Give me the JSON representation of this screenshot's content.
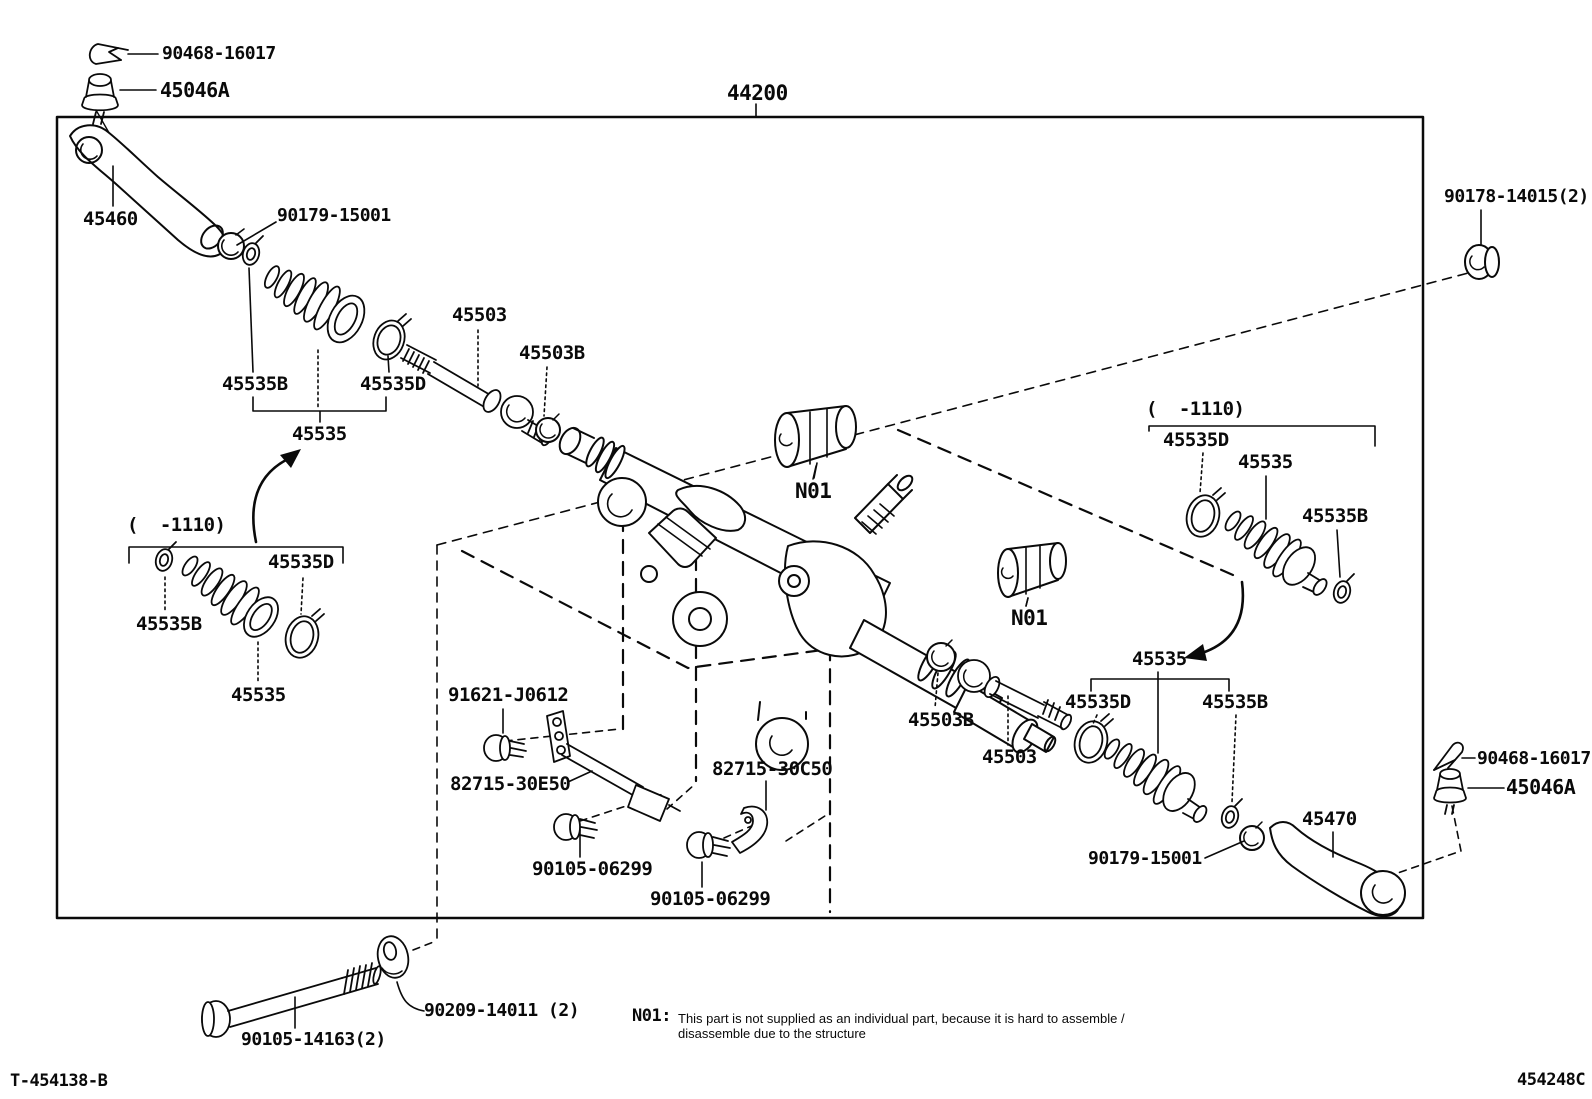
{
  "labels": {
    "clip_top": "90468-16017",
    "tre_top": "45046A",
    "assembly": "44200",
    "arm_left": "45460",
    "nut_left": "90179-15001",
    "rack_top": "45503",
    "washer_top": "45503B",
    "clampB_top": "45535B",
    "clampD_top": "45535D",
    "boot_top": "45535",
    "range_left": "(  -1110)",
    "clampD_left": "45535D",
    "clampB_left": "45535B",
    "boot_left": "45535",
    "n01_a": "N01",
    "n01_b": "N01",
    "nut_top_right": "90178-14015(2)",
    "range_right": "(  -1110)",
    "clampD_right": "45535D",
    "boot_right": "45535",
    "clampB_right": "45535B",
    "boot_lower": "45535",
    "clampD_lower": "45535D",
    "clampB_lower": "45535B",
    "washer_lower": "45503B",
    "rack_lower": "45503",
    "bolt_sensor": "91621-J0612",
    "link_e50": "82715-30E50",
    "link_c50": "82715-30C50",
    "bolt_06299_a": "90105-06299",
    "bolt_06299_b": "90105-06299",
    "nut_right_lower": "90179-15001",
    "pitman_arm": "45470",
    "clip_bottom": "90468-16017",
    "tre_bottom": "45046A",
    "washer_bl": "90209-14011 (2)",
    "bolt_bl": "90105-14163(2)"
  },
  "note": {
    "ref": "N01:",
    "line1": "This part is not supplied as an individual part, because it is hard to assemble /",
    "line2": "disassemble due to the structure"
  },
  "footer": {
    "doc_left": "T-454138-B",
    "doc_right": "454248C"
  },
  "colors": {
    "ink": "#0a0a0a",
    "background": "#ffffff"
  }
}
